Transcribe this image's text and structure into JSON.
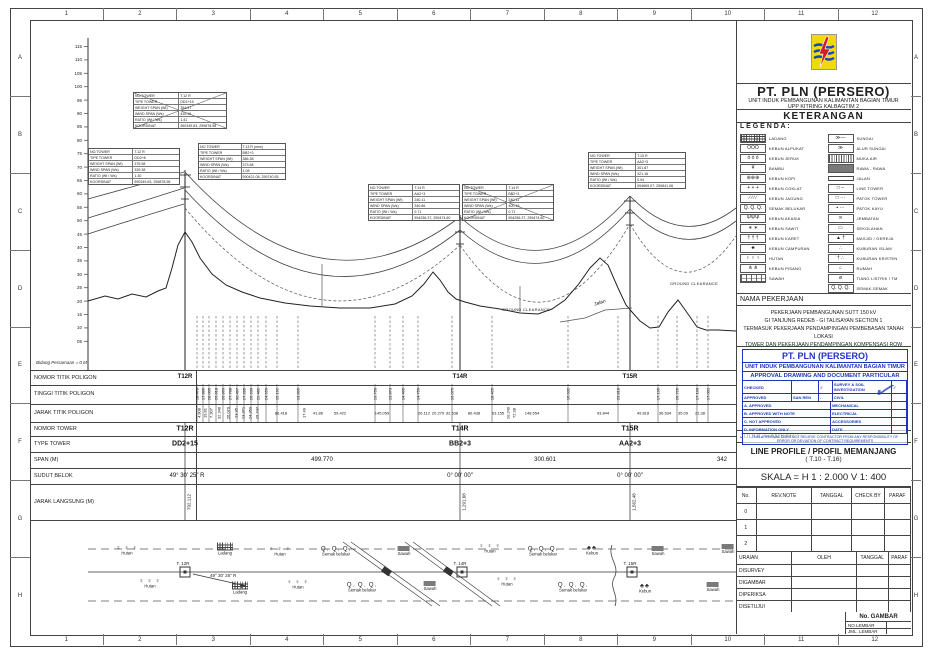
{
  "frame": {
    "cols": [
      "1",
      "2",
      "3",
      "4",
      "5",
      "6",
      "7",
      "8",
      "9",
      "10",
      "11",
      "12"
    ],
    "rows": [
      "A",
      "B",
      "C",
      "D",
      "E",
      "F",
      "G",
      "H"
    ]
  },
  "header": {
    "company": "PT. PLN (PERSERO)",
    "unit": "UNIT INDUK PEMBANGUNAN KALIMANTAN BAGIAN TIMUR",
    "upp": "UPP KITRING KALBAGTIM 2",
    "keterangan": "KETERANGAN",
    "legenda": "L E G E N D A :"
  },
  "legend": {
    "left": [
      {
        "label": "LADANG",
        "pat": "grid"
      },
      {
        "label": "KEBUN ALPUKAT",
        "g": "OOO"
      },
      {
        "label": "KEBUN JERUK",
        "g": "ó ó ó"
      },
      {
        "label": "BAMBU",
        "g": "¥"
      },
      {
        "label": "KEBUN KOPI",
        "g": "⊕⊕⊕"
      },
      {
        "label": "KEBUN COKLAT",
        "g": "+ + +"
      },
      {
        "label": "KEBUN JAGUNG",
        "g": "∕ ∕ ∕ ∕"
      },
      {
        "label": "SEMAK BELUKAR",
        "g": "Q. Q. Q."
      },
      {
        "label": "KEBUN AKASIA",
        "g": "ΨΨΨ"
      },
      {
        "label": "KEBUN SAWIT",
        "g": "∗ ∗"
      },
      {
        "label": "KEBUN KARET",
        "g": "† † †"
      },
      {
        "label": "KEBUN CAMPURAN",
        "g": "♣"
      },
      {
        "label": "HUTAN",
        "g": "♀ ♀ ♀"
      },
      {
        "label": "KEBUN PISANG",
        "g": "⋔ ⋔"
      },
      {
        "label": "SAWAH",
        "pat": "brick"
      }
    ],
    "right": [
      {
        "label": "SUNGAI",
        "g": "≫—"
      },
      {
        "label": "ALUR SUNGAI",
        "g": "≫"
      },
      {
        "label": "MUKA AIR",
        "pat": "hatch"
      },
      {
        "label": "RAWA - RAWA",
        "pat": "dark"
      },
      {
        "label": "JALAN",
        "pat": "road"
      },
      {
        "label": "LINE TOWER",
        "g": "□ –"
      },
      {
        "label": "PATOK TOWER",
        "g": "□ ···"
      },
      {
        "label": "PATOK KAYU",
        "g": "▪ ···"
      },
      {
        "label": "JEMBATAN",
        "g": "≍"
      },
      {
        "label": "SEKOLAHAN",
        "g": "▭"
      },
      {
        "label": "MASJID / GEREJA",
        "g": "▲ †"
      },
      {
        "label": "KUBURAN ISLAM",
        "g": "∴"
      },
      {
        "label": "KUBURAN KRISTEN",
        "g": "† ∴"
      },
      {
        "label": "RUMAH",
        "g": "⌂"
      },
      {
        "label": "TIANG LISTRIK / TM",
        "g": "ø"
      },
      {
        "label": "SEMAK-SEMAK",
        "g": "Q. Q. Q."
      }
    ]
  },
  "nama_pekerjaan": {
    "title": "NAMA PEKERJAAN",
    "lines": [
      "PEKERJAAN PEMBANGUNAN SUTT 150 kV",
      "GI TANJUNG REDEB - GI TALISAYAN SECTION 1",
      "TERMASUK PEKERJAAN PENDAMPINGAN PEMBEBASAN TANAH LOKASI",
      "TOWER DAN PEKERJAAN PENDAMPINGAN KOMPENSASI ROW"
    ]
  },
  "stamp": {
    "title1": "PT. PLN (PERSERO)",
    "title2": "UNIT INDUK PEMBANGUNAN KALIMANTAN BAGIAN TIMUR",
    "title3": "APPROVAL DRAWING AND DOCUMENT PARTICULAR",
    "left_rows": [
      [
        "CHECKED",
        "",
        "✓"
      ],
      [
        "APPROVED",
        "SAN REN",
        "-"
      ]
    ],
    "right_top_rows": [
      [
        "SURVEY & SOIL INVESTIGATION",
        "✓"
      ],
      [
        "CIVIL",
        ""
      ]
    ],
    "option_rows": [
      "A. APPROVED",
      "B. APPROVED WITH NOTE",
      "C. NOT APPROVED",
      "D. INFORMATION ONLY"
    ],
    "discipline_rows": [
      "MECHANICAL",
      "ELECTRICAL",
      "ACCESSORIES",
      "DATE"
    ],
    "footer": "THIS APPROVAL DOES NOT RELIEVE CONTRACTOR FROM ANY RESPONSIBILITY OF ERROR OR DEVIATION OF CONTRACT REQUIREMENTS",
    "mark": "✓"
  },
  "judul": {
    "label": "JUDUL GAMBAR :",
    "title": "LINE PROFILE / PROFIL MEMANJANG",
    "subtitle": "( T.10 - T.16)",
    "skala": "SKALA  =  H 1 : 2.000    V 1: 400"
  },
  "rev_table": {
    "headers": [
      "No.",
      "REV.NOTE",
      "TANGGAL",
      "CHECK BY",
      "PARAF"
    ],
    "rows": [
      "0",
      "1",
      "2"
    ]
  },
  "sign_table": {
    "headers": [
      "URAIAN",
      "OLEH",
      "TANGGAL",
      "PARAF"
    ],
    "rows": [
      "DISURVEY",
      "DIGAMBAR",
      "DIPERIKSA",
      "DISETUJUI"
    ]
  },
  "gambar": {
    "no_gambar": "No. GAMBAR",
    "no_lembar": "NO.LEMBAR",
    "jml_lembar": "JML. LEMBAR"
  },
  "profile": {
    "bidang": "Bidang Persamaan = 0 M",
    "ground_clearance": "GROUND CLEARANCE",
    "jalan": "Jalan",
    "y_ticks": [
      "115",
      "110",
      "105",
      "100",
      "95",
      "90",
      "85",
      "80",
      "75",
      "70",
      "65",
      "60",
      "55",
      "50",
      "45",
      "40",
      "35",
      "30",
      "25",
      "20",
      "15",
      "10",
      "05"
    ],
    "tower_boxes": [
      {
        "x": 133,
        "y": 92,
        "w": 92,
        "crossed": true,
        "rows": [
          [
            "NO.TOWER",
            "T.12 R"
          ],
          [
            "TIPE TOWER",
            "DD2+15"
          ],
          [
            "WEIGHT SPAN (Wt)",
            "394.97"
          ],
          [
            "WIND SPAN (Ws)",
            "410.19"
          ],
          [
            "RATIO (Wt / Ws)",
            "1.41"
          ],
          [
            "KOORDINAT",
            "590349.63, 259878.98"
          ]
        ]
      },
      {
        "x": 88,
        "y": 148,
        "w": 90,
        "crossed": false,
        "rows": [
          [
            "NO.TOWER",
            "T.12 R"
          ],
          [
            "TIPE TOWER",
            "DD2+8"
          ],
          [
            "WEIGHT SPAN (Wt)",
            "375.98"
          ],
          [
            "WIND SPAN (Ws)",
            "339.38"
          ],
          [
            "RATIO (Wt / Ws)",
            "1.30"
          ],
          [
            "KOORDINAT",
            "590349.63, 259878.98"
          ]
        ]
      },
      {
        "x": 198,
        "y": 143,
        "w": 86,
        "crossed": false,
        "rows": [
          [
            "NO.TOWER",
            "T.13 R (new)"
          ],
          [
            "TIPE TOWER",
            "BB2+3"
          ],
          [
            "WEIGHT SPAN (Wt)",
            "386.38"
          ],
          [
            "WIND SPAN (Ws)",
            "373.58"
          ],
          [
            "RATIO (Wt / Ws)",
            "1.08"
          ],
          [
            "KOORDINAT",
            "590421.08, 259740.55"
          ]
        ]
      },
      {
        "x": 368,
        "y": 184,
        "w": 90,
        "crossed": false,
        "rows": [
          [
            "NO.TOWER",
            "T.14 R"
          ],
          [
            "TIPE TOWER",
            "AA2+3"
          ],
          [
            "WEIGHT SPAN (Wt)",
            "240.11"
          ],
          [
            "WIND SPAN (Ws)",
            "340.86"
          ],
          [
            "RATIO (Wt / Ws)",
            "0.71"
          ],
          [
            "KOORDINAT",
            "594256.37, 259474.60"
          ]
        ]
      },
      {
        "x": 462,
        "y": 184,
        "w": 90,
        "crossed": true,
        "rows": [
          [
            "NO.TOWER",
            "T.14 R"
          ],
          [
            "TIPE TOWER",
            "BB2+3"
          ],
          [
            "WEIGHT SPAN (Wt)",
            "240.11"
          ],
          [
            "WIND SPAN (Ws)",
            "400.19"
          ],
          [
            "RATIO (Wt / Ws)",
            "0.71"
          ],
          [
            "KOORDINAT",
            "594256.37, 259474.60"
          ]
        ]
      },
      {
        "x": 588,
        "y": 152,
        "w": 96,
        "crossed": false,
        "rows": [
          [
            "NO.TOWER",
            "T.15 R"
          ],
          [
            "TIPE TOWER",
            "AA2+3"
          ],
          [
            "WEIGHT SPAN (Wt)",
            "301.87"
          ],
          [
            "WIND SPAN (Ws)",
            "321.16"
          ],
          [
            "RATIO (Wt / Ws)",
            "0.94"
          ],
          [
            "KOORDINAT",
            "594669.07, 259841.06"
          ]
        ]
      }
    ],
    "table": {
      "row_labels": [
        "NOMOR TITIK POLIGON",
        "TINGGI TITIK POLIGON",
        "JARAK TITIK POLIGON",
        "NOMOR TOWER",
        "TYPE TOWER",
        "SPAN (M)",
        "SUDUT BELOK",
        "JARAK LANGSUNG (M)"
      ],
      "poligon_nos": [
        {
          "x": 185,
          "v": "T12R"
        },
        {
          "x": 460,
          "v": "T14R"
        },
        {
          "x": 630,
          "v": "T15R"
        }
      ],
      "tower_nos": [
        {
          "x": 185,
          "v": "T12R"
        },
        {
          "x": 460,
          "v": "T14R"
        },
        {
          "x": 630,
          "v": "T15R"
        }
      ],
      "tower_types": [
        {
          "x": 185,
          "v": "DD2+15"
        },
        {
          "x": 460,
          "v": "BB2+3"
        },
        {
          "x": 630,
          "v": "AA2+3"
        }
      ],
      "spans": [
        {
          "x": 322,
          "v": "499.770"
        },
        {
          "x": 545,
          "v": "300.601"
        },
        {
          "x": 722,
          "v": "342"
        }
      ],
      "sudut": [
        {
          "x": 187,
          "v": "49° 30' 25\" R"
        },
        {
          "x": 460,
          "v": "0° 00' 00\""
        },
        {
          "x": 630,
          "v": "0° 00' 00\""
        }
      ],
      "jarak_langsung": [
        {
          "x": 189,
          "v": "792.112"
        },
        {
          "x": 464,
          "v": "1,291.68"
        },
        {
          "x": 634,
          "v": "1,562.48"
        }
      ],
      "tinggi": [
        {
          "x": 197,
          "v": "18.478"
        },
        {
          "x": 203,
          "v": "17.886"
        },
        {
          "x": 209,
          "v": "28.005"
        },
        {
          "x": 216,
          "v": "26.818"
        },
        {
          "x": 223,
          "v": "26.869"
        },
        {
          "x": 230,
          "v": "27.788"
        },
        {
          "x": 237,
          "v": "30.497"
        },
        {
          "x": 244,
          "v": "27.285"
        },
        {
          "x": 251,
          "v": "26.639"
        },
        {
          "x": 258,
          "v": "22.482"
        },
        {
          "x": 266,
          "v": "24.559"
        },
        {
          "x": 277,
          "v": "15.192"
        },
        {
          "x": 298,
          "v": "13.895"
        },
        {
          "x": 375,
          "v": "13.750"
        },
        {
          "x": 390,
          "v": "13.873"
        },
        {
          "x": 403,
          "v": "14.495"
        },
        {
          "x": 418,
          "v": "14.759"
        },
        {
          "x": 452,
          "v": "16.075"
        },
        {
          "x": 492,
          "v": "18.425"
        },
        {
          "x": 568,
          "v": "16.032"
        },
        {
          "x": 618,
          "v": "23.818"
        },
        {
          "x": 658,
          "v": "17.195"
        },
        {
          "x": 677,
          "v": "26.726"
        },
        {
          "x": 697,
          "v": "17.190"
        },
        {
          "x": 708,
          "v": "17.001"
        }
      ],
      "jarak": [
        {
          "x": 199,
          "v": "4.908",
          "r": 1
        },
        {
          "x": 205,
          "v": "19.81",
          "r": 1
        },
        {
          "x": 211,
          "v": "7.307",
          "r": 1
        },
        {
          "x": 219,
          "v": "32.346",
          "r": 1
        },
        {
          "x": 228,
          "v": "26.079",
          "r": 1
        },
        {
          "x": 236,
          "v": "23.35",
          "r": 1
        },
        {
          "x": 243,
          "v": "13.371",
          "r": 1
        },
        {
          "x": 250,
          "v": "24.350",
          "r": 1
        },
        {
          "x": 257,
          "v": "15.747",
          "r": 1
        },
        {
          "x": 281,
          "v": "86.418"
        },
        {
          "x": 304,
          "v": "17.49",
          "r": 1
        },
        {
          "x": 318,
          "v": "41.86"
        },
        {
          "x": 340,
          "v": "59.422"
        },
        {
          "x": 382,
          "v": "145.059"
        },
        {
          "x": 424,
          "v": "26.112"
        },
        {
          "x": 438,
          "v": "20.279"
        },
        {
          "x": 452,
          "v": "32.538"
        },
        {
          "x": 474,
          "v": "86.438"
        },
        {
          "x": 498,
          "v": "63.155"
        },
        {
          "x": 508,
          "v": "10.249",
          "r": 1
        },
        {
          "x": 514,
          "v": "72.38",
          "r": 1
        },
        {
          "x": 532,
          "v": "148.554"
        },
        {
          "x": 603,
          "v": "93.844"
        },
        {
          "x": 643,
          "v": "49.818"
        },
        {
          "x": 665,
          "v": "36.534"
        },
        {
          "x": 683,
          "v": "35.09"
        },
        {
          "x": 700,
          "v": "21.38"
        }
      ]
    }
  },
  "plan": {
    "angle": "49° 30' 25\" R",
    "towers": [
      {
        "x": 185,
        "label": "T. 12R"
      },
      {
        "x": 462,
        "label": "T. 14R"
      },
      {
        "x": 632,
        "label": "T. 15R"
      }
    ],
    "items": [
      {
        "x": 127,
        "y": 551,
        "sym": "trees",
        "label": "Hutan"
      },
      {
        "x": 225,
        "y": 549,
        "sym": "ladang",
        "label": "Ladang"
      },
      {
        "x": 280,
        "y": 552,
        "sym": "trees",
        "label": "Hutan"
      },
      {
        "x": 336,
        "y": 552,
        "sym": "semak",
        "label": "Semak belukar"
      },
      {
        "x": 404,
        "y": 551,
        "sym": "sawah",
        "label": "Sawah"
      },
      {
        "x": 490,
        "y": 549,
        "sym": "trees",
        "label": "Hutan"
      },
      {
        "x": 543,
        "y": 552,
        "sym": "semak",
        "label": "Semak belukar"
      },
      {
        "x": 592,
        "y": 551,
        "sym": "kebun",
        "label": "Kebun"
      },
      {
        "x": 658,
        "y": 551,
        "sym": "sawah",
        "label": "Sawah"
      },
      {
        "x": 728,
        "y": 549,
        "sym": "sawah",
        "label": "Sawah"
      },
      {
        "x": 150,
        "y": 584,
        "sym": "trees",
        "label": "Hutan"
      },
      {
        "x": 240,
        "y": 588,
        "sym": "ladang",
        "label": "Ladang"
      },
      {
        "x": 298,
        "y": 585,
        "sym": "trees",
        "label": "Hutan"
      },
      {
        "x": 362,
        "y": 588,
        "sym": "semak",
        "label": "Semak belukar"
      },
      {
        "x": 430,
        "y": 586,
        "sym": "sawah",
        "label": "Sawah"
      },
      {
        "x": 507,
        "y": 582,
        "sym": "trees",
        "label": "Hutan"
      },
      {
        "x": 573,
        "y": 588,
        "sym": "semak",
        "label": "Semak belukar"
      },
      {
        "x": 645,
        "y": 589,
        "sym": "kebun",
        "label": "Kebun"
      },
      {
        "x": 713,
        "y": 587,
        "sym": "sawah",
        "label": "Sawah"
      }
    ]
  }
}
